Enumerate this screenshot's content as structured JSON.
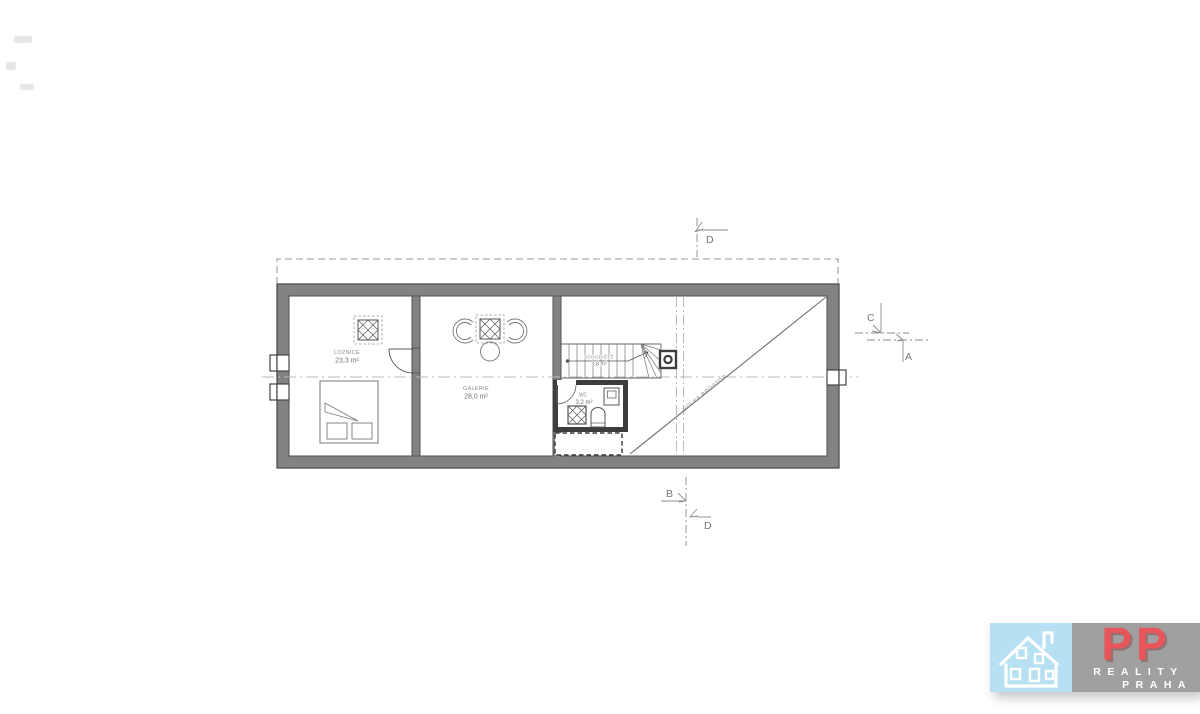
{
  "plan": {
    "rooms": {
      "bedroom": {
        "name": "LOŽNICE",
        "area": "23,3 m²"
      },
      "gallery": {
        "name": "GALERIE",
        "area": "28,0 m²"
      },
      "staircase": {
        "name": "SCHODIŠTĚ",
        "area": "3,8 m²"
      },
      "wc": {
        "name": "WC",
        "area": "3,2 m²"
      },
      "open_space": {
        "name": "VOLNÝ PROSTOR"
      }
    },
    "section_markers": {
      "top": "D",
      "right_upper": "C",
      "right_lower": "A",
      "bottom_upper": "B",
      "bottom_lower": "D"
    },
    "colors": {
      "wall_fill": "#828282",
      "wall_outline": "#4f4f4f",
      "wc_wall": "#3d3d3d",
      "centerline": "#b8b8b8",
      "label_text": "#8a8a8a"
    }
  },
  "logo": {
    "brand": "PP",
    "tagline_line1": "REALITY",
    "tagline_line2": "PRAHA",
    "colors": {
      "house_panel": "#b7e1f3",
      "text_panel": "#a0a0a0",
      "brand_red": "#e9565a",
      "tagline_white": "#ffffff"
    }
  }
}
